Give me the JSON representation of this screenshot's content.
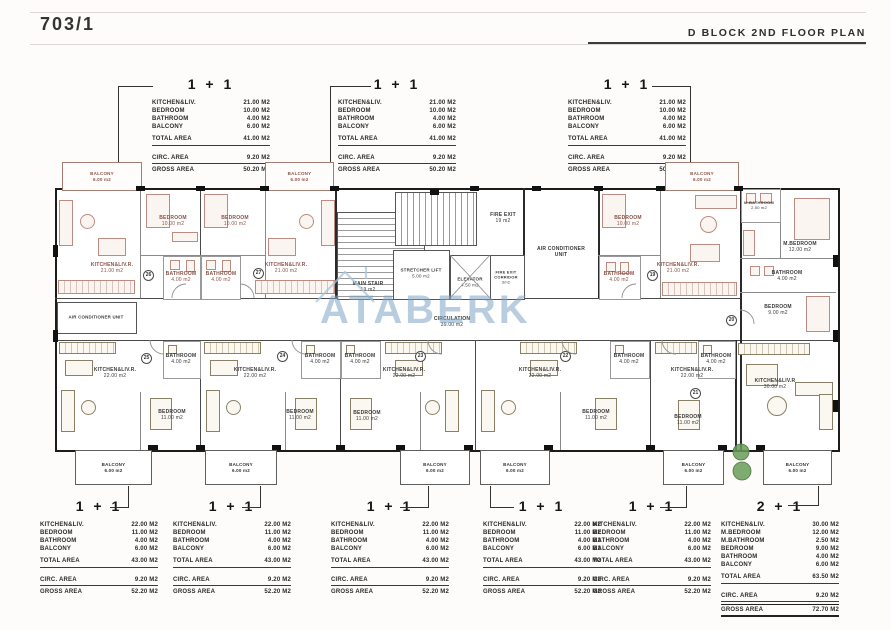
{
  "header": {
    "sheet_no": "703/1",
    "plan_title": "D BLOCK 2ND FLOOR PLAN"
  },
  "watermark": {
    "text": "ATABERK"
  },
  "unit_types": {
    "a": {
      "title": "1 + 1",
      "rooms": [
        {
          "label": "KITCHEN&LIV.",
          "value": "21.00 M2"
        },
        {
          "label": "BEDROOM",
          "value": "10.00 M2"
        },
        {
          "label": "BATHROOM",
          "value": "4.00 M2"
        },
        {
          "label": "BALCONY",
          "value": "6.00 M2"
        }
      ],
      "total_label": "TOTAL AREA",
      "total_value": "41.00 M2",
      "circ_label": "CIRC. AREA",
      "circ_value": "9.20 M2",
      "gross_label": "GROSS AREA",
      "gross_value": "50.20 M2"
    },
    "b": {
      "title": "1 + 1",
      "rooms": [
        {
          "label": "KITCHEN&LIV.",
          "value": "22.00 M2"
        },
        {
          "label": "BEDROOM",
          "value": "11.00 M2"
        },
        {
          "label": "BATHROOM",
          "value": "4.00 M2"
        },
        {
          "label": "BALCONY",
          "value": "6.00 M2"
        }
      ],
      "total_label": "TOTAL AREA",
      "total_value": "43.00 M2",
      "circ_label": "CIRC. AREA",
      "circ_value": "9.20 M2",
      "gross_label": "GROSS AREA",
      "gross_value": "52.20 M2"
    },
    "c": {
      "title": "2 + 1",
      "rooms": [
        {
          "label": "KITCHEN&LIV.",
          "value": "30.00 M2"
        },
        {
          "label": "M.BEDROOM",
          "value": "12.00 M2"
        },
        {
          "label": "M.BATHROOM",
          "value": "2.50 M2"
        },
        {
          "label": "BEDROOM",
          "value": "9.00 M2"
        },
        {
          "label": "BATHROOM",
          "value": "4.00 M2"
        },
        {
          "label": "BALCONY",
          "value": "6.00 M2"
        }
      ],
      "total_label": "TOTAL AREA",
      "total_value": "63.50 M2",
      "circ_label": "CIRC. AREA",
      "circ_value": "9.20 M2",
      "gross_label": "GROSS AREA",
      "gross_value": "72.70 M2"
    }
  },
  "plan": {
    "rooms": {
      "balcony": {
        "name": "BALCONY",
        "area": "6.00 m2"
      },
      "kitchen_top": {
        "name": "KITCHEN&LIV.R.",
        "area": "21.00 m2"
      },
      "bedroom_top": {
        "name": "BEDROOM",
        "area": "10.00 m2"
      },
      "bathroom": {
        "name": "BATHROOM",
        "area": "4.00 m2"
      },
      "kitchen_bottom": {
        "name": "KITCHEN&LIV.R.",
        "area": "22.00 m2"
      },
      "bedroom_bottom": {
        "name": "BEDROOM",
        "area": "11.00 m2"
      },
      "kitchen_2p1": {
        "name": "KITCHEN&LIV.R",
        "area": "30.00 m2"
      },
      "m_bedroom": {
        "name": "M.BEDROOM",
        "area": "12.00 m2"
      },
      "m_bathroom": {
        "name": "M.BATHROOM",
        "area": "2.50 m2"
      },
      "bedroom9": {
        "name": "BEDROOM",
        "area": "9.00 m2"
      },
      "main_stair": {
        "name": "MAIN STAIR",
        "area": "19 m2"
      },
      "fire_exit": {
        "name": "FIRE EXIT",
        "area": "19 m2"
      },
      "fire_corridor": {
        "name": "FIRE EXIT CORRIDOR",
        "area": "3m2"
      },
      "stretcher": {
        "name": "STRETCHER LIFT",
        "area": "5.00 m2"
      },
      "elevator": {
        "name": "ELEVATOR",
        "area": "4.50 m2"
      },
      "circulation": {
        "name": "CIRCULATION",
        "area": "39.00 m2"
      },
      "ac_unit": {
        "name": "AIR CONDITIONER UNIT"
      }
    },
    "unit_numbers": {
      "t_left": "26",
      "t_mid": "27",
      "t_right": "19",
      "two_plus_one": "20",
      "b1": "25",
      "b2": "24",
      "b3": "23",
      "b4": "22",
      "b5": "21"
    }
  },
  "colors": {
    "watermark_blue": "#7da4c4",
    "furniture_top": "#bd8b7f",
    "furniture_bottom": "#8a8066",
    "tree_green": "#699b57",
    "wall_black": "#1c1c1c"
  }
}
